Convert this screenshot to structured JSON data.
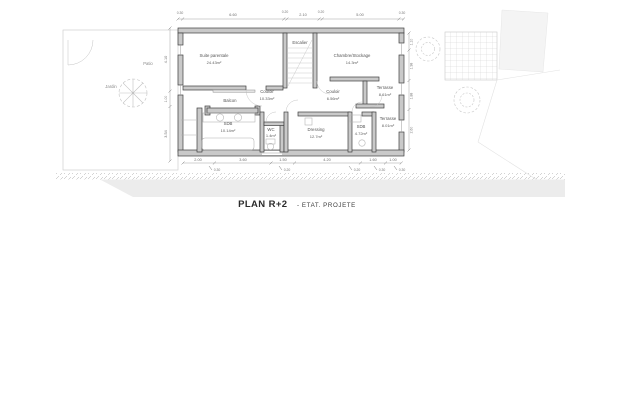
{
  "title": {
    "main": "PLAN R+2",
    "suffix": "- ETAT. PROJETE"
  },
  "rooms": {
    "suite_parentale": {
      "name": "Suite parentale",
      "area": "24.43m²"
    },
    "escalier": {
      "name": "Escalier"
    },
    "chambre_stockage": {
      "name": "Chambre/Stockage",
      "area": "14.3m²"
    },
    "couloir_1": {
      "name": "Couloir",
      "area": "10.33m²"
    },
    "couloir_2": {
      "name": "Couloir",
      "area": "6.56m²"
    },
    "balcon": {
      "name": "Balcon"
    },
    "sdb_1": {
      "name": "SDB",
      "area": "10.14m²"
    },
    "wc": {
      "name": "WC",
      "area": "1.4m²"
    },
    "dressing": {
      "name": "Dressing",
      "area": "12.7m²"
    },
    "sdb_2": {
      "name": "SDB",
      "area": "4.72m²"
    },
    "terrasse_1": {
      "name": "Terrasse",
      "area": "8.61m²"
    },
    "terrasse_2": {
      "name": "Terrasse",
      "area": "8.01m²"
    }
  },
  "site": {
    "jardin": "Jardin",
    "patio": "Patio"
  },
  "dims": {
    "top": [
      "0.30",
      "6.60",
      "0.20",
      "2.10",
      "0.20",
      "5.00",
      "0.30"
    ],
    "bottom": [
      "2.00",
      "3.60",
      "1.50",
      "4.20",
      "1.60",
      "1.00"
    ],
    "bottom_sub": [
      "0.30",
      "0.20",
      "0.20",
      "0.30",
      "0.30"
    ],
    "left": [
      "4.10",
      "1.00",
      "3.54"
    ],
    "right": [
      "1.10",
      "1.98",
      "1.88",
      "2.60"
    ]
  },
  "colors": {
    "wall_fill": "#c9c9c9",
    "wall_stroke": "#3f3f3f",
    "fixture_line": "#b0b0b0",
    "dim_text": "#6d6d6d",
    "ground_wash": "#ececec"
  }
}
